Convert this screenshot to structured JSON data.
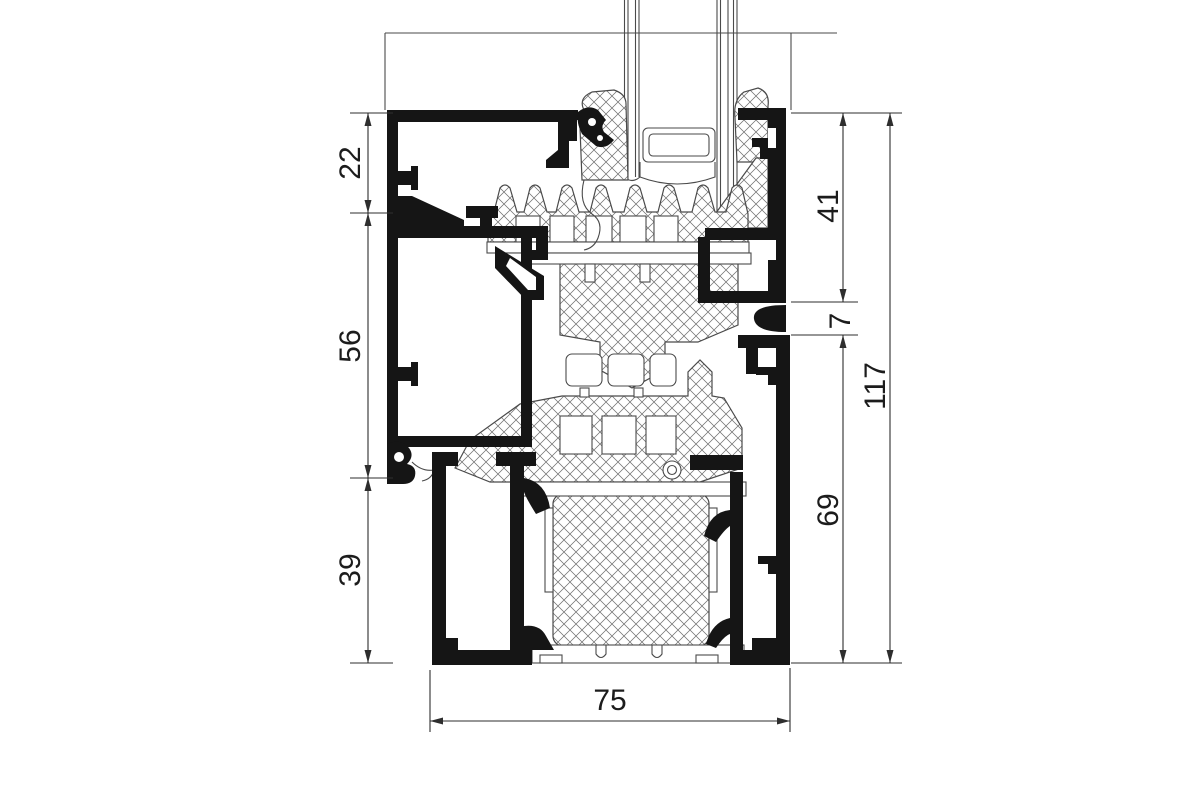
{
  "figure": {
    "type": "technical-drawing",
    "subject": "aluminium window frame profile cross-section"
  },
  "dimensions": {
    "left": [
      {
        "label": "22"
      },
      {
        "label": "56"
      },
      {
        "label": "39"
      }
    ],
    "right": [
      {
        "label": "41"
      },
      {
        "label": "7"
      },
      {
        "label": "69"
      },
      {
        "label": "117"
      }
    ],
    "bottom": [
      {
        "label": "75"
      }
    ]
  },
  "colors": {
    "background": "#ffffff",
    "profile": "#151515",
    "thin_line": "#4a4a4a",
    "hatch_line": "#707070",
    "dimension": "#2e2e2e",
    "text": "#1c1c1c"
  }
}
